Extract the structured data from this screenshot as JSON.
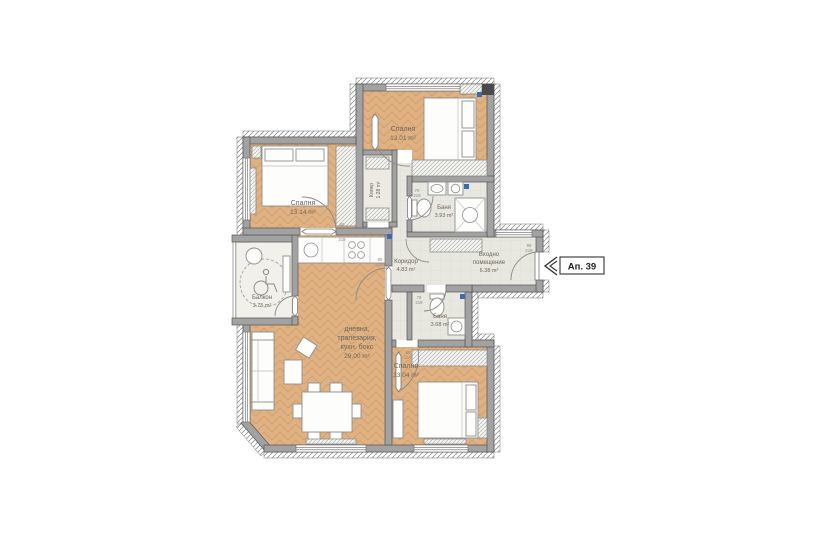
{
  "plan": {
    "apartment_tag": "Ап. 39",
    "rooms": {
      "bedroom_top": {
        "name": "Спалня",
        "area": "13.01 m²"
      },
      "bedroom_left": {
        "name": "Спалня",
        "area": "13.14 m²"
      },
      "bedroom_bottom": {
        "name": "Спалня",
        "area": "13.04 m²"
      },
      "bath_top": {
        "name": "Баня",
        "area": "3.93 m²"
      },
      "bath_bottom": {
        "name": "Баня",
        "area": "3.68 m²"
      },
      "corridor": {
        "name": "Коридор",
        "area": "4.83 m²"
      },
      "entry": {
        "line1": "Входно",
        "line2": "помещение",
        "area": "6.38 m²"
      },
      "living": {
        "line1": "дневна,",
        "line2": "трапезария,",
        "line3": "кухн. бокс",
        "area": "29.00 m²"
      },
      "balcony": {
        "name": "Балкон",
        "area": "3.75 m²"
      },
      "closet": {
        "name": "Килер",
        "area": "1.28 m²"
      }
    },
    "door_labels": [
      {
        "w": "80",
        "h": "219"
      },
      {
        "w": "70",
        "h": "219"
      },
      {
        "w": "90",
        "h": "219"
      }
    ],
    "colors": {
      "wood": "#dfb183",
      "wood_line": "#c69459",
      "tile": "#e9e8e0",
      "wall": "#a2a2a2",
      "wall_edge": "#555555",
      "accent_blue": "#3a6ab0",
      "label_text": "#6b655c"
    }
  }
}
